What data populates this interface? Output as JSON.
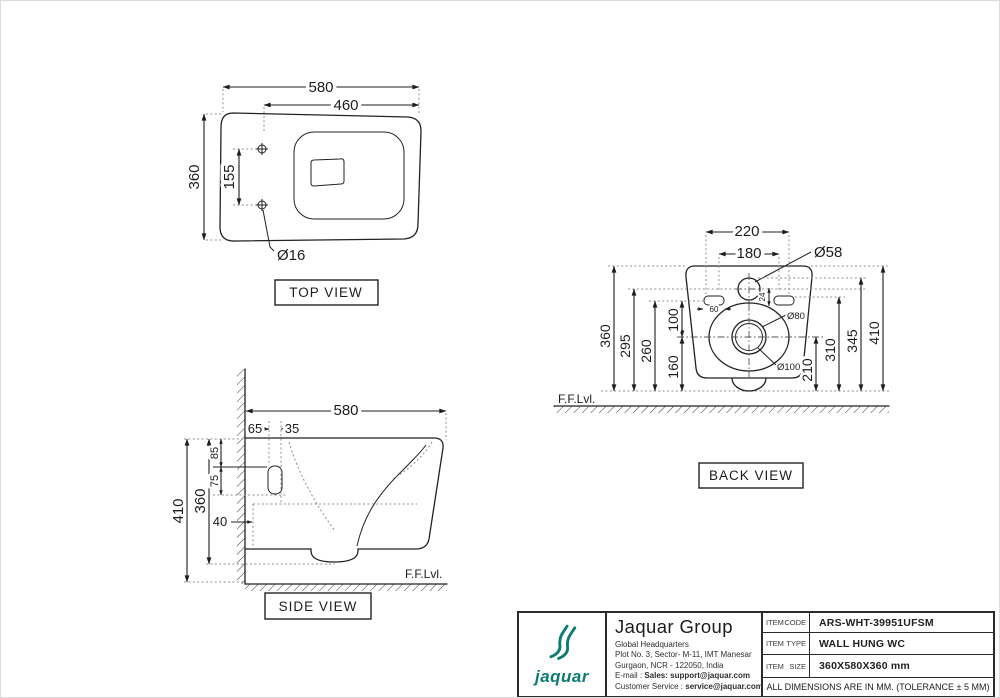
{
  "views": {
    "top": {
      "label": "TOP VIEW",
      "d580": "580",
      "d460": "460",
      "d360": "360",
      "d155": "155",
      "dia16": "Ø16"
    },
    "side": {
      "label": "SIDE VIEW",
      "ffl": "F.F.Lvl.",
      "d580": "580",
      "d65": "65",
      "d35": "35",
      "d85": "85",
      "d75": "75",
      "d410": "410",
      "d360": "360",
      "d40": "40"
    },
    "back": {
      "label": "BACK VIEW",
      "ffl": "F.F.Lvl.",
      "d220": "220",
      "d180": "180",
      "dia58": "Ø58",
      "d360": "360",
      "d295": "295",
      "d260": "260",
      "d100": "100",
      "d160": "160",
      "d60": "60",
      "d24": "24",
      "dia80": "Ø80",
      "dia100": "Ø100",
      "d210": "210",
      "d310": "310",
      "d345": "345",
      "d410": "410"
    }
  },
  "titleblock": {
    "brand_color": "#0c7b72",
    "logo_text": "jaquar",
    "company": "Jaquar Group",
    "address1": "Global Headquarters",
    "address2": "Plot No. 3, Sector- M-11, IMT Manesar",
    "address3": "Gurgaon, NCR - 122050, India",
    "email_label": "E-mail : ",
    "email_value": "Sales: support@jaquar.com",
    "cs_label": "Customer Service : ",
    "cs_value": "service@jaquar.com",
    "rows": [
      {
        "k1": "ITEM",
        "k2": "CODE",
        "value": "ARS-WHT-39951UFSM"
      },
      {
        "k1": "ITEM",
        "k2": "TYPE",
        "value": "WALL HUNG WC"
      },
      {
        "k1": "ITEM",
        "k2": "SIZE",
        "value": "360X580X360 mm"
      }
    ],
    "note": "ALL DIMENSIONS ARE IN MM. (TOLERANCE ± 5 MM)"
  }
}
